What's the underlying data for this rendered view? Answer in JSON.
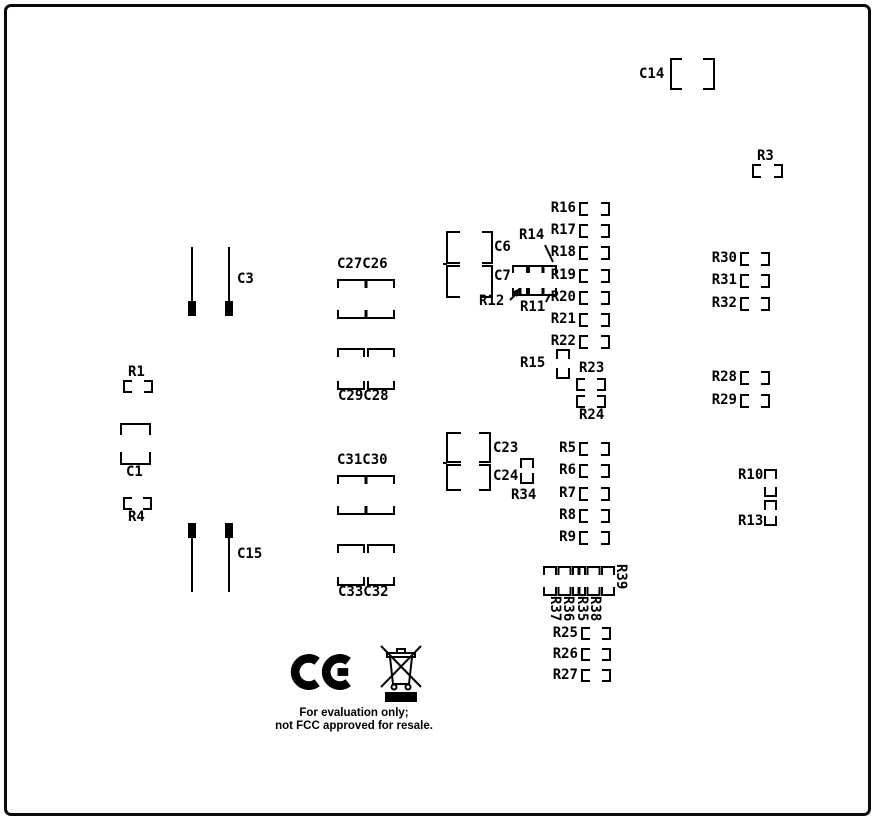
{
  "colors": {
    "silkscreen": "#000000",
    "board": "#ffffff"
  },
  "refdes": {
    "c1": "C1",
    "c3": "C3",
    "c6": "C6",
    "c7": "C7",
    "c14": "C14",
    "c15": "C15",
    "c23": "C23",
    "c24": "C24",
    "c27c26": "C27C26",
    "c29c28": "C29C28",
    "c31c30": "C31C30",
    "c33c32": "C33C32",
    "r1": "R1",
    "r3": "R3",
    "r4": "R4",
    "r5": "R5",
    "r6": "R6",
    "r7": "R7",
    "r8": "R8",
    "r9": "R9",
    "r10": "R10",
    "r11": "R11",
    "r12": "R12",
    "r13": "R13",
    "r14": "R14",
    "r15": "R15",
    "r16": "R16",
    "r17": "R17",
    "r18": "R18",
    "r19": "R19",
    "r20": "R20",
    "r21": "R21",
    "r22": "R22",
    "r23": "R23",
    "r24": "R24",
    "r25": "R25",
    "r26": "R26",
    "r27": "R27",
    "r28": "R28",
    "r29": "R29",
    "r30": "R30",
    "r31": "R31",
    "r32": "R32",
    "r34": "R34",
    "r35": "R35",
    "r36": "R36",
    "r37": "R37",
    "r38": "R38",
    "r39": "R39"
  },
  "marks": {
    "ce": "CE"
  },
  "notes": {
    "line1": "For evaluation only;",
    "line2": "not FCC approved for resale."
  }
}
